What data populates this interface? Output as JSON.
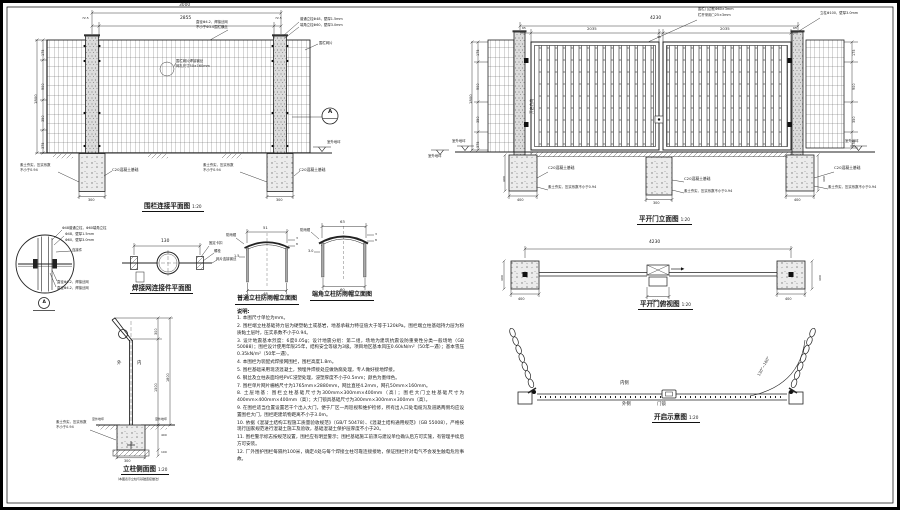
{
  "fence": {
    "title": "围栏连接平面图",
    "scale": "1:20",
    "dim_overall": "3000",
    "dim_inner": "2855",
    "dim_end_left": "72.5",
    "dim_end_right": "72.5",
    "dim_total_height": "1800",
    "dim_v1": "175",
    "dim_v2": "900",
    "dim_v3": "350",
    "dim_v4": "375",
    "dim_found_left": "300",
    "dim_found_right": "300",
    "ann_wire_1": "直径Φ4.2，焊接丝网",
    "ann_wire_2": "不小于Φ3.0围栏横丝",
    "ann_mesh_1": "围栏网片焊接钢丝",
    "ann_mesh_2": "网孔尺寸50×160mm",
    "label_post_common": "普通立柱Φ48，壁厚1.5mm",
    "label_post_corner": "端角立柱Φ60，壁厚3.0mm",
    "label_mesh": "围栏网片",
    "label_ground": "室外地坪",
    "label_ground_2": "室外地坪",
    "label_c20_left": "C20混凝土基础",
    "label_c20_right": "C20混凝土基础",
    "label_soil_left_1": "素土夯实，压实系数",
    "label_soil_left_2": "不小于0.94",
    "label_soil_mid_1": "素土夯实，压实系数",
    "label_soil_mid_2": "不小于0.94",
    "detail_ref": "A"
  },
  "gate": {
    "title": "平开门立面图",
    "scale": "1:20",
    "dim_overall": "4230",
    "dim_leaf_left": "2035",
    "dim_leaf_right": "2035",
    "dim_gap": "30",
    "dim_end_left": "65",
    "dim_end_right": "65",
    "dim_total_height": "1800",
    "dim_v1": "175",
    "dim_v2": "900",
    "dim_v3": "350",
    "dim_v4": "375",
    "dim_rv1": "175",
    "dim_rv2": "900",
    "dim_rv3": "350",
    "dim_rv4": "375",
    "label_frame_1": "围栏门边框Φ60×3mm",
    "label_frame_2": "栏杆采用□25×3mm",
    "label_post": "立柱Φ100，壁厚3.0mm",
    "label_open_dir": "开启方向",
    "label_ground_left": "室外地坪",
    "label_ground_right": "室外地坪",
    "label_c20_left": "C20混凝土基础",
    "label_c20_mid": "C20混凝土基础",
    "label_c20_right": "C20混凝土基础",
    "label_soil_left": "素土夯实，压实系数不小于0.94",
    "label_soil_mid": "素土夯实，压实系数不小于0.94",
    "label_soil_right": "素土夯实，压实系数不小于0.94",
    "dim_found_left": "400",
    "dim_found_mid": "300",
    "dim_found_right": "400",
    "dim_found_depth_left": "400",
    "dim_found_depth_right": "400"
  },
  "detail_a": {
    "label_1": "Φ48普通立柱，Φ60端角立柱",
    "label_2": "Φ48，壁厚1.5mm",
    "label_3": "Φ60，壁厚3.0mm",
    "label_4": "连接件",
    "label_5": "直径Φ4.2，焊接丝网",
    "label_6": "直径Φ4.2，焊接丝网",
    "ref": "A"
  },
  "connector": {
    "title": "焊接网连接件平面图",
    "dim_width": "130",
    "label_1": "固定卡扣",
    "label_2": "螺栓",
    "label_3": "网片连接钢丝"
  },
  "cap_common": {
    "title": "普通立柱防雨帽立面图",
    "dim_top": "51",
    "dim_bottom": "48",
    "dim_wall": "1.5",
    "dim_r1": "3",
    "dim_r2": "8",
    "label_cap": "防雨帽"
  },
  "cap_corner": {
    "title": "端角立柱防雨帽立面图",
    "dim_top": "63",
    "dim_bottom": "60",
    "dim_wall": "3.0",
    "dim_r1": "3",
    "dim_r2": "8",
    "label_cap": "防雨帽"
  },
  "top_view": {
    "title": "平开门俯视图",
    "scale": "1:20",
    "dim_overall": "4230",
    "dim_found_left": "400",
    "dim_found_mid": "300",
    "dim_found_right": "400",
    "dim_side_left": "400",
    "dim_side_right": "400"
  },
  "side_view": {
    "title": "立柱侧面图",
    "scale": "1:20",
    "subtitle": "（本图表示立柱与基础连接做法）",
    "dim_arm": "300",
    "dim_post": "1500",
    "dim_total": "1800",
    "dim_depth": "400",
    "dim_gravel": "100",
    "dim_found": "300",
    "label_out": "外",
    "label_in": "内",
    "label_ground_left": "室外地坪",
    "label_ground_right": "室外地坪",
    "label_soil_1": "素土夯实，压实系数",
    "label_soil_2": "不小于0.94"
  },
  "opening": {
    "title": "开启示意图",
    "scale": "1:20",
    "label_inner": "内侧",
    "label_outer": "外侧",
    "label_lock": "门锁",
    "label_angle": "130°~160°"
  },
  "notes": {
    "heading": "说明:",
    "items": [
      "1. 本图尺寸单位为mm。",
      "2. 围栏端立柱基础持力层为硬塑黏土或基岩，地基承载力特征值大于等于120kPa。围栏端立柱基础持力层为粉质黏土层时，压实系数不小于0.94。",
      "3. 设计地震基本烈度：6度0.05g；设计地震分组：第二组，场地为建筑抗震设防重要性分类一般场地（GB 50088）；围栏设计使用年限25年，结构安全等级为3级。项目地区基本风压0.60kN/m²（50年一遇）；基本雪压0.35kN/m²（50年一遇）。",
      "4. 本围栏为装配式焊接网围栏，围栏高度1.8m。",
      "5. 围栏基础采用现浇混凝土，预埋件焊接处应做防腐处理，专人做好接地焊接。",
      "6. 钢丝及立柱表面均经PVC浸塑处理，浸塑厚度不小于0.5mm；颜色为墨绿色。",
      "7. 围栏单片网片栅格尺寸为1765mm×2880mm，网丝直径4.2mm，网孔50mm×160mm。",
      "8. 土层地基：围栏立柱基础尺寸为300mm×300mm×400mm（高）；围栏大门立柱基础尺寸为400mm×400mm×400mm（高）；大门锁具基础尺寸为300mm×300mm×300mm（高）。",
      "9. 在围栏适当位置设置若干个出入大门，便于厂区一周巡视和维护检修，所有出入口处电缆沟及道路两侧均应设置围栏大门，围栏距建筑物距离不小于3.0m。",
      "10. 依据《混凝土结构工程施工质量验收规范》（GB/T 50478）、《混凝土结构通用规范》（GB 55008），严格按现行国家规范进行混凝土施工及验收，基础混凝土保护层厚度不小于20。",
      "11. 围栏警示标志按规范设置，围栏应有明显警示；围栏基础施工前须与建设单位确认后方可实施，有管理手续后方可安装。",
      "12. 厂外围护围栏每隔约100米，确定4处与每个焊接立柱可靠连接接地，保证围栏针对电气不会发生触电危险事故。"
    ]
  }
}
